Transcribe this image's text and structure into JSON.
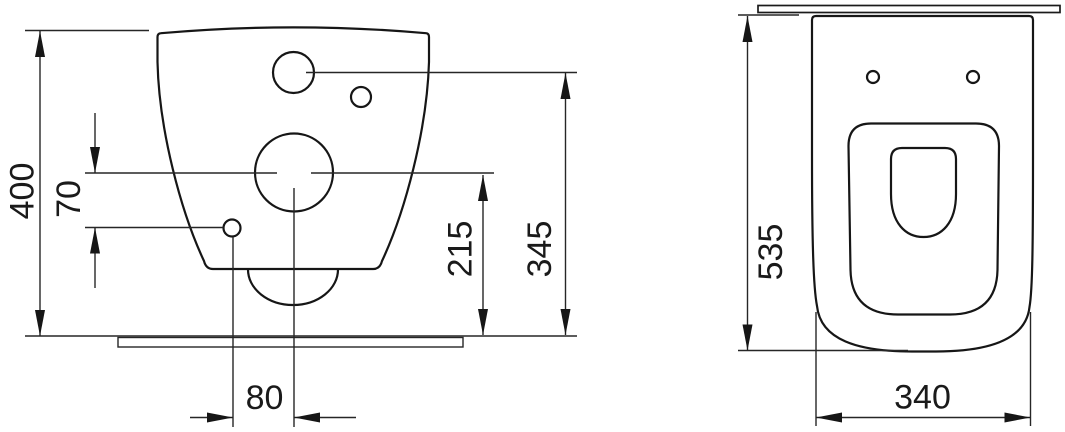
{
  "colors": {
    "line": "#1a1a1a",
    "background": "#ffffff"
  },
  "rear_view": {
    "overall_height": "400",
    "fixing_hole_offset": "70",
    "outlet_center_height": "215",
    "inlet_center_height": "345",
    "fixing_hole_spacing": "80"
  },
  "top_view": {
    "overall_depth": "535",
    "overall_width": "340"
  }
}
